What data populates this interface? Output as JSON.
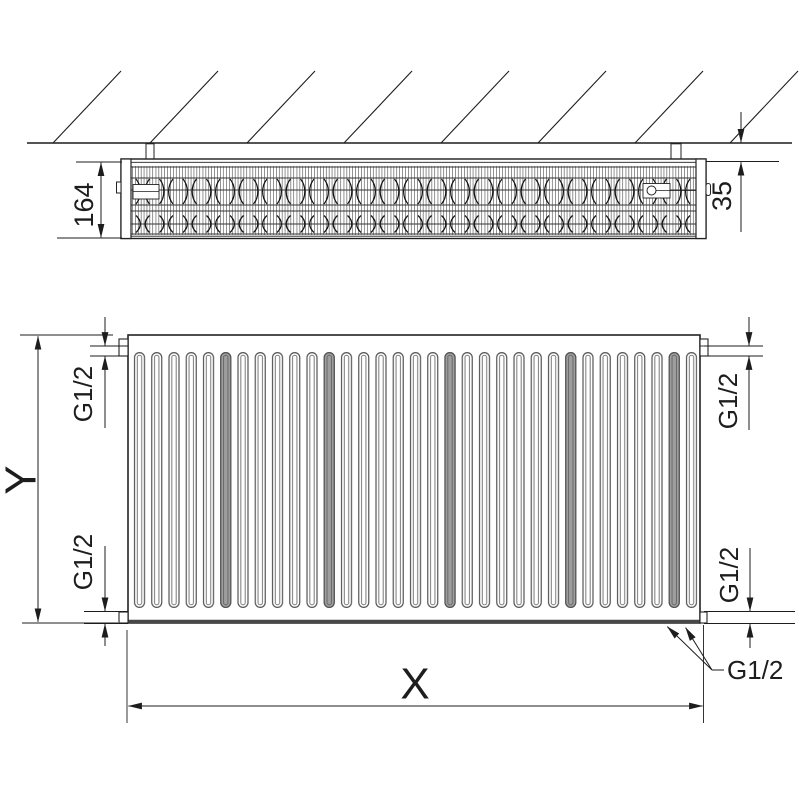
{
  "labels": {
    "depth": "164",
    "wall_gap": "35",
    "height": "Y",
    "width": "X",
    "conn_top_left": "G1/2",
    "conn_bottom_left": "G1/2",
    "conn_top_right": "G1/2",
    "conn_bottom_right": "G1/2",
    "conn_bottom_leader": "G1/2"
  },
  "colors": {
    "line": "#1d1d1d",
    "slot_gray": "#9e9e9e",
    "background": "#ffffff"
  }
}
